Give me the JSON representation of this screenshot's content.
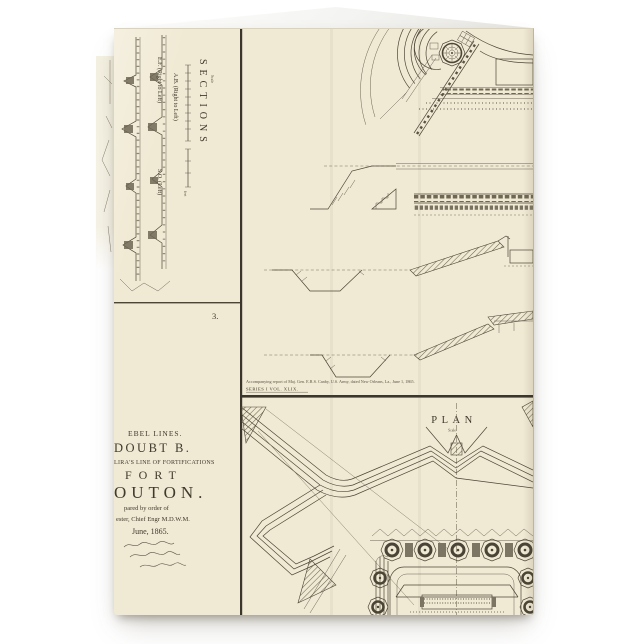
{
  "card": {
    "paper_color": "#f0e9d3",
    "ink_color": "#4e4637",
    "sections_panel": {
      "title": "SECTIONS",
      "scale_label": "Scale",
      "feet_label": "feet",
      "labels": {
        "ef": "E.F. (Right to Left)",
        "so": "S.O. (Left)",
        "ab": "A.B. (Right to Left)"
      },
      "plate_number": "3."
    },
    "title_block": {
      "lines": [
        "EBEL LINES.",
        "DOUBT B.",
        "LIRA'S LINE OF FORTIFICATIONS",
        "FORT",
        "OUTON.",
        "pared by order of",
        "ester, Chief Engr M.D.W.M.",
        "June, 1865."
      ]
    },
    "caption": {
      "report_line": "Accompanying report of Maj. Gen. E.R.S. Canby, U.S. Army, dated New Orleans, La., June 1, 1865.",
      "series_line": "SERIES I VOL. XLIX."
    },
    "plan_panel": {
      "title": "PLAN",
      "scale_label": "Scale"
    }
  }
}
